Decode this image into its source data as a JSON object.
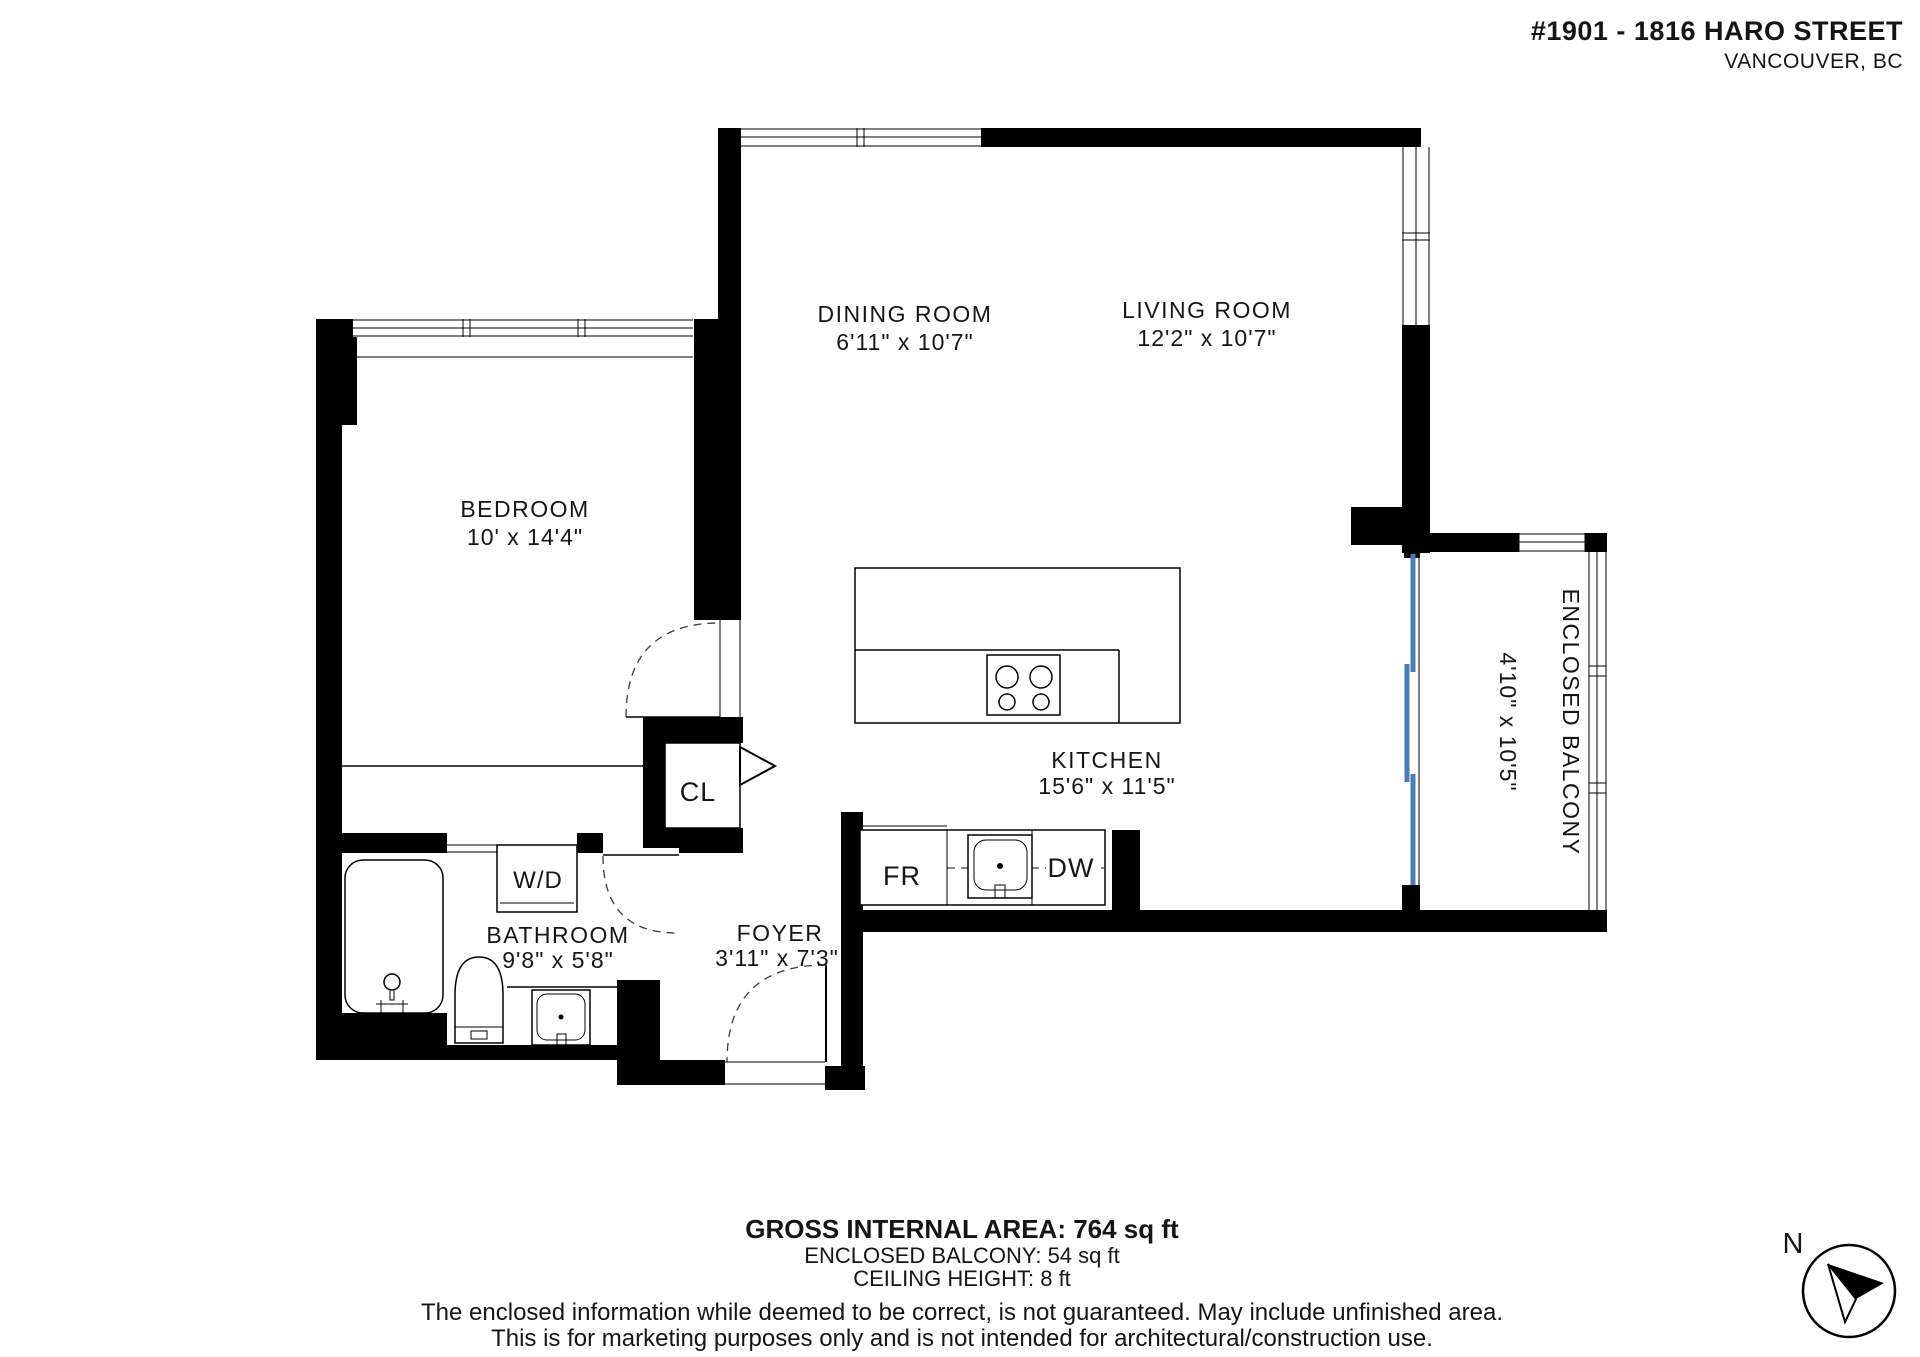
{
  "header": {
    "address_line1": "#1901 - 1816 HARO STREET",
    "address_line2": "VANCOUVER, BC"
  },
  "rooms": {
    "bedroom": {
      "name": "BEDROOM",
      "dims": "10' x 14'4\""
    },
    "dining": {
      "name": "DINING ROOM",
      "dims": "6'11\" x 10'7\""
    },
    "living": {
      "name": "LIVING ROOM",
      "dims": "12'2\" x 10'7\""
    },
    "kitchen": {
      "name": "KITCHEN",
      "dims": "15'6\" x 11'5\""
    },
    "bathroom": {
      "name": "BATHROOM",
      "dims": "9'8\" x 5'8\""
    },
    "foyer": {
      "name": "FOYER",
      "dims": "3'11\" x 7'3\""
    },
    "balcony": {
      "name": "ENCLOSED BALCONY",
      "dims": "4'10\" x 10'5\""
    }
  },
  "fixtures": {
    "closet": "CL",
    "washer_dryer": "W/D",
    "fridge": "FR",
    "dishwasher": "DW"
  },
  "footer": {
    "area": "GROSS INTERNAL AREA: 764 sq ft",
    "balcony_area": "ENCLOSED BALCONY: 54 sq ft",
    "ceiling": "CEILING HEIGHT: 8 ft",
    "disclaimer1": "The enclosed information while deemed to be correct, is not guaranteed. May include unfinished area.",
    "disclaimer2": "This is for marketing purposes only and is not intended for architectural/construction use."
  },
  "compass": {
    "label": "N"
  },
  "colors": {
    "wall": "#000000",
    "slider_door": "#4a7cb5",
    "text": "#151515"
  }
}
